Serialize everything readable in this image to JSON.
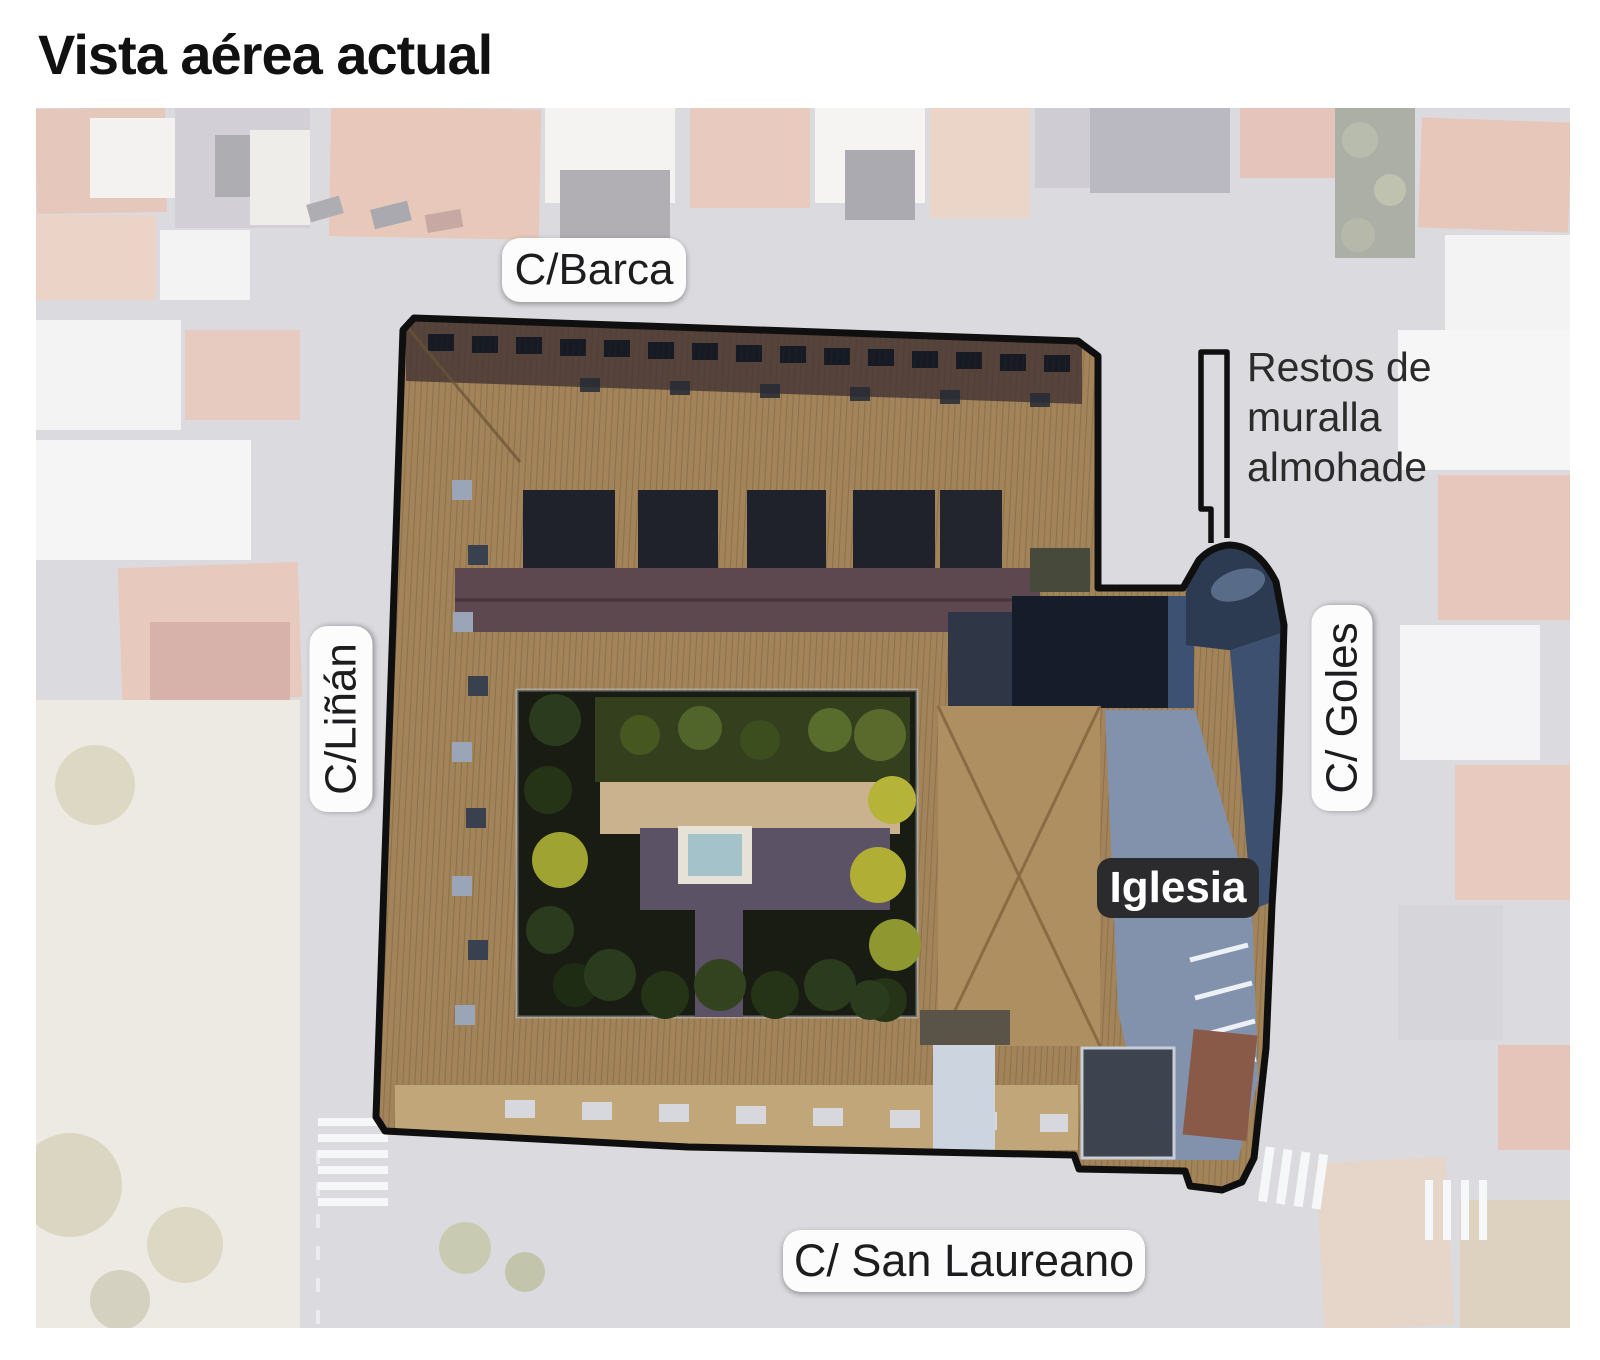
{
  "title": "Vista aérea actual",
  "map": {
    "street_labels": [
      {
        "id": "barca",
        "label": "C/Barca"
      },
      {
        "id": "linan",
        "label": "C/Liñán"
      },
      {
        "id": "goles",
        "label": "C/ Goles"
      },
      {
        "id": "san-laureano",
        "label": "C/ San Laureano"
      }
    ],
    "building_labels": [
      {
        "id": "iglesia",
        "label": "Iglesia"
      }
    ],
    "annotations": [
      {
        "id": "muralla",
        "label": "Restos de muralla almohade"
      }
    ]
  },
  "colors": {
    "outline": "#0f0f0f",
    "street_pill_bg": "#fcfcfd",
    "street_pill_text": "#1d1d1f",
    "building_pill_bg": "#2b2b2d",
    "building_pill_text": "#ffffff",
    "annotation_text": "#2b2b2b",
    "title_text": "#111111"
  }
}
